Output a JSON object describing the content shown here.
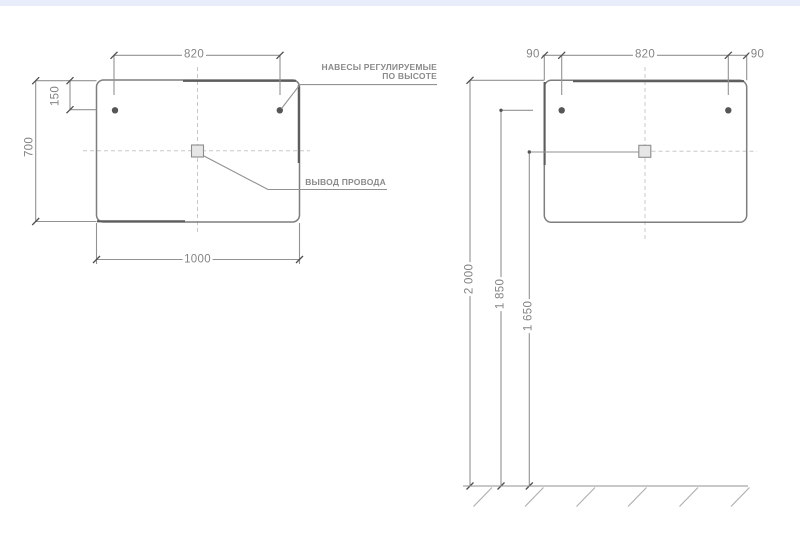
{
  "app": {
    "background": "#ffffff",
    "top_bar_color": "#e9edfb"
  },
  "front_view": {
    "title_semantic": "mirror front view with dimensions",
    "hanger_spacing": "820",
    "hanger_offset_top": "150",
    "mirror_height": "700",
    "mirror_width": "1000",
    "note_hangers_line1": "НАВЕСЫ РЕГУЛИРУЕМЫЕ",
    "note_hangers_line2": "ПО ВЫСОТЕ",
    "note_wire": "ВЫВОД ПРОВОДА"
  },
  "installation_view": {
    "title_semantic": "wall installation heights",
    "offset_left": "90",
    "hanger_spacing": "820",
    "offset_right": "90",
    "height_top": "2 000",
    "height_hangers": "1 850",
    "height_wire_outlet": "1 650"
  },
  "colors": {
    "line": "#929292",
    "line_dark": "#5c5c5c",
    "dashed_line": "#c8c8c8",
    "text": "#848484"
  }
}
